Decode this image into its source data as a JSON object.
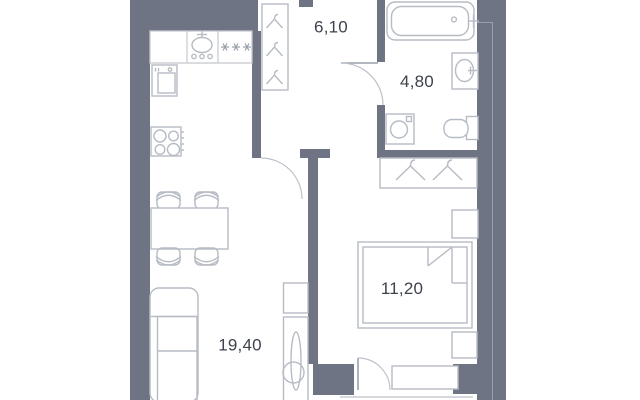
{
  "floor_plan": {
    "type": "apartment-floor-plan",
    "rooms": [
      {
        "id": "hallway",
        "area_label": "6,10"
      },
      {
        "id": "bathroom",
        "area_label": "4,80"
      },
      {
        "id": "bedroom",
        "area_label": "11,20"
      },
      {
        "id": "living-kitchen",
        "area_label": "19,40"
      }
    ],
    "colors": {
      "background": "#ffffff",
      "wall": "#6f7485",
      "furniture_outline": "#b7bbc4",
      "counter_outline": "#c5c8cf",
      "door_leaf": "#9aa0ab",
      "label_text": "#3d424d"
    },
    "icons": [
      "bathtub-icon",
      "washbasin-icon",
      "toilet-icon",
      "washing-machine-icon",
      "hanger-icon",
      "wardrobe-icon",
      "bed-icon",
      "bedside-table-icon",
      "sofa-icon",
      "mirror-cabinet-icon",
      "dining-table-icon",
      "chair-icon",
      "kitchen-sink-icon",
      "fridge-snowflakes-icon",
      "oven-icon",
      "stove-icon",
      "door-swing-icon",
      "balcony-window-icon"
    ]
  }
}
